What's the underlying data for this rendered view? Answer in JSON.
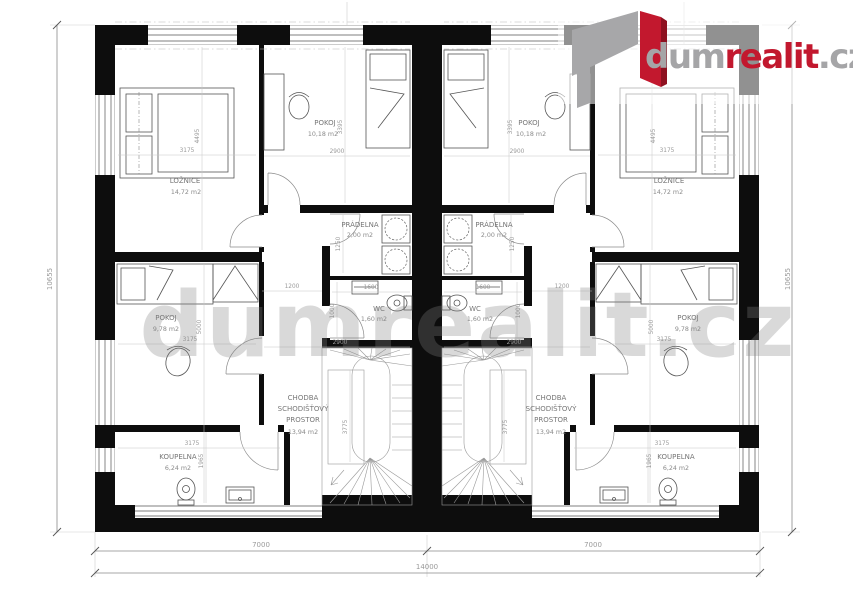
{
  "brand": {
    "logo_gray_1": "dum",
    "logo_red": "realit",
    "logo_gray_2": ".cz",
    "gray": "#a5a5a7",
    "red": "#c2182e"
  },
  "watermark_text": "dumrealit.cz",
  "rooms": {
    "loznice": {
      "name": "LOŽNICE",
      "area": "14,72 m2"
    },
    "pokoj_horni": {
      "name": "POKOJ",
      "area": "10,18 m2"
    },
    "pradelna": {
      "name": "PRÁDELNA",
      "area": "2,00 m2"
    },
    "wc": {
      "name": "WC",
      "area": "1,60 m2"
    },
    "pokoj_dolni": {
      "name": "POKOJ",
      "area": "9,78 m2"
    },
    "chodba": {
      "name_line1": "CHODBA",
      "name_line2": "SCHODIŠŤOVÝ",
      "name_line3": "PROSTOR",
      "area": "13,94 m2"
    },
    "koupelna": {
      "name": "KOUPELNA",
      "area": "6,24 m2"
    }
  },
  "dimensions": {
    "total_width": "14000",
    "unit_width": "7000",
    "total_depth": "10655",
    "loznice_w": "3175",
    "loznice_d": "4495",
    "pokoj_horni_w": "2900",
    "pokoj_horni_d": "3395",
    "pradelna_d": "1250",
    "chodba_w": "1200",
    "wc_w": "1600",
    "wc_d": "1000",
    "pokoj_dolni_w": "3175",
    "pokoj_dolni_d": "5000",
    "koupelna_w": "3175",
    "koupelna_d": "1965",
    "schodiste_w": "2900",
    "schodiste_d": "3775"
  }
}
